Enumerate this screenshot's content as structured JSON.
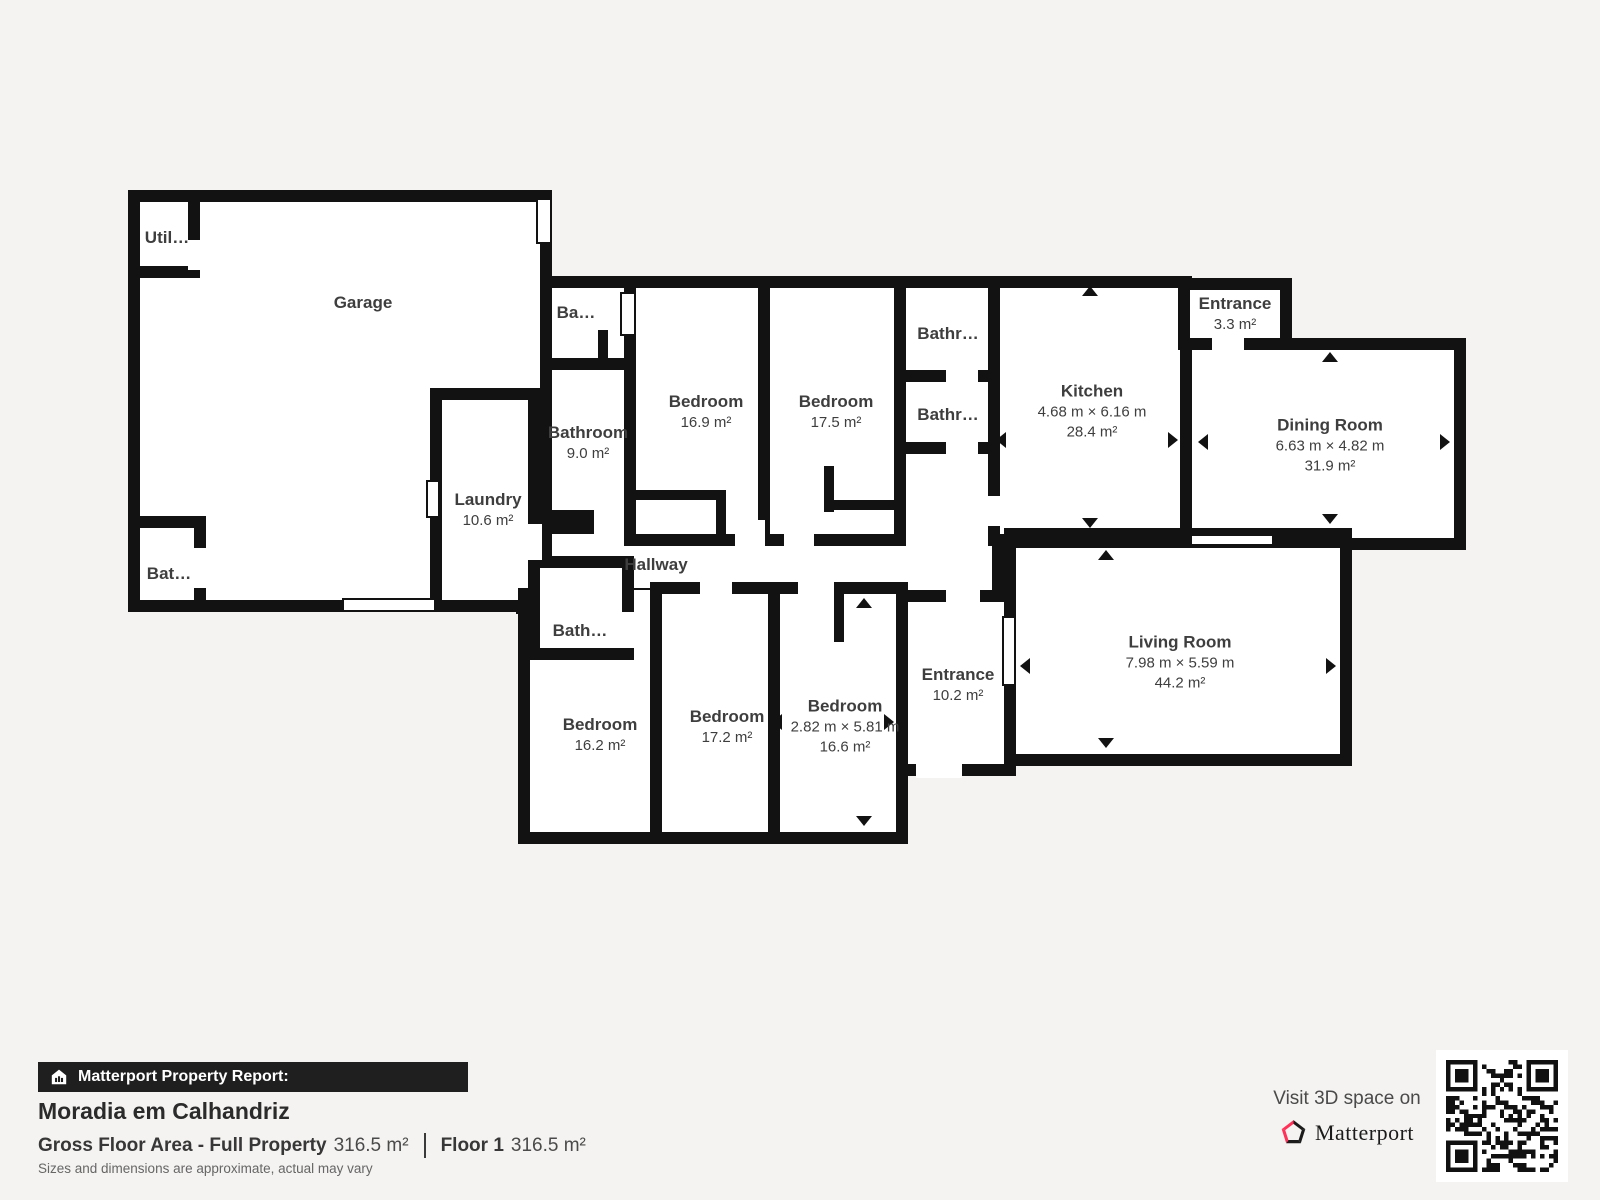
{
  "plan": {
    "rooms": [
      {
        "id": "garage",
        "name": "Garage",
        "dims": "",
        "area": ""
      },
      {
        "id": "utility",
        "name": "Util…",
        "dims": "",
        "area": ""
      },
      {
        "id": "bathroom-garage",
        "name": "Bat…",
        "dims": "",
        "area": ""
      },
      {
        "id": "laundry",
        "name": "Laundry",
        "dims": "",
        "area": "10.6 m²"
      },
      {
        "id": "bathroom-small-top",
        "name": "Ba…",
        "dims": "",
        "area": ""
      },
      {
        "id": "bathroom-9",
        "name": "Bathroom",
        "dims": "",
        "area": "9.0 m²"
      },
      {
        "id": "bedroom-16-9",
        "name": "Bedroom",
        "dims": "",
        "area": "16.9 m²"
      },
      {
        "id": "bedroom-17-5",
        "name": "Bedroom",
        "dims": "",
        "area": "17.5 m²"
      },
      {
        "id": "bathroom-upper",
        "name": "Bathr…",
        "dims": "",
        "area": ""
      },
      {
        "id": "bathroom-lower",
        "name": "Bathr…",
        "dims": "",
        "area": ""
      },
      {
        "id": "kitchen",
        "name": "Kitchen",
        "dims": "4.68 m × 6.16 m",
        "area": "28.4 m²"
      },
      {
        "id": "entrance-small",
        "name": "Entrance",
        "dims": "",
        "area": "3.3 m²"
      },
      {
        "id": "dining-room",
        "name": "Dining Room",
        "dims": "6.63 m × 4.82 m",
        "area": "31.9 m²"
      },
      {
        "id": "hallway",
        "name": "Hallway",
        "dims": "",
        "area": ""
      },
      {
        "id": "bathroom-hall",
        "name": "Bath…",
        "dims": "",
        "area": ""
      },
      {
        "id": "bedroom-16-2",
        "name": "Bedroom",
        "dims": "",
        "area": "16.2 m²"
      },
      {
        "id": "bedroom-17-2",
        "name": "Bedroom",
        "dims": "",
        "area": "17.2 m²"
      },
      {
        "id": "bedroom-16-6",
        "name": "Bedroom",
        "dims": "2.82 m × 5.81 m",
        "area": "16.6 m²"
      },
      {
        "id": "entrance-main",
        "name": "Entrance",
        "dims": "",
        "area": "10.2 m²"
      },
      {
        "id": "living-room",
        "name": "Living Room",
        "dims": "7.98 m × 5.59 m",
        "area": "44.2 m²"
      }
    ]
  },
  "footer": {
    "report_label": "Matterport Property Report:",
    "property_name": "Moradia em Calhandriz",
    "gross_label": "Gross Floor Area - Full Property",
    "gross_value": "316.5 m²",
    "floor_label": "Floor 1",
    "floor_value": "316.5 m²",
    "disclaimer": "Sizes and dimensions are approximate, actual may vary",
    "visit_label": "Visit 3D space on",
    "brand": "Matterport"
  },
  "colors": {
    "background": "#f4f3f1",
    "wall": "#121212",
    "room_fill": "#ffffff",
    "text": "#3e3e3e",
    "banner_bg": "#1f1f1f",
    "brand_pink": "#ff3158"
  }
}
